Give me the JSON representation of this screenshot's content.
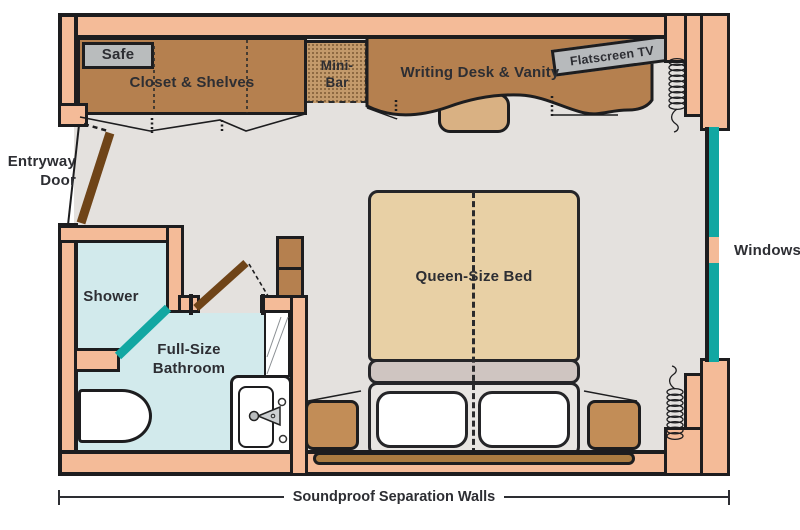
{
  "diagram": "cabin-floor-plan",
  "labels": {
    "safe": "Safe",
    "closet": "Closet & Shelves",
    "minibar": "Mini-Bar",
    "desk": "Writing Desk & Vanity",
    "tv": "Flatscreen TV",
    "entryway": "Entryway Door",
    "shower": "Shower",
    "bathroom": "Full-Size Bathroom",
    "bed": "Queen-Size Bed",
    "windows": "Windows",
    "soundproof": "Soundproof Separation Walls"
  },
  "colors": {
    "wall_fill": "#f4bb98",
    "outline": "#1d1d1f",
    "floor": "#e4e1de",
    "bathroom_floor": "#d2eaec",
    "wood_furniture": "#b5804f",
    "bed_fill": "#e8d0a5",
    "window_glass": "#12a7a2",
    "door_leaf": "#6f4418",
    "appliance_gray": "#b9bcbd",
    "text": "#2d2e33"
  }
}
